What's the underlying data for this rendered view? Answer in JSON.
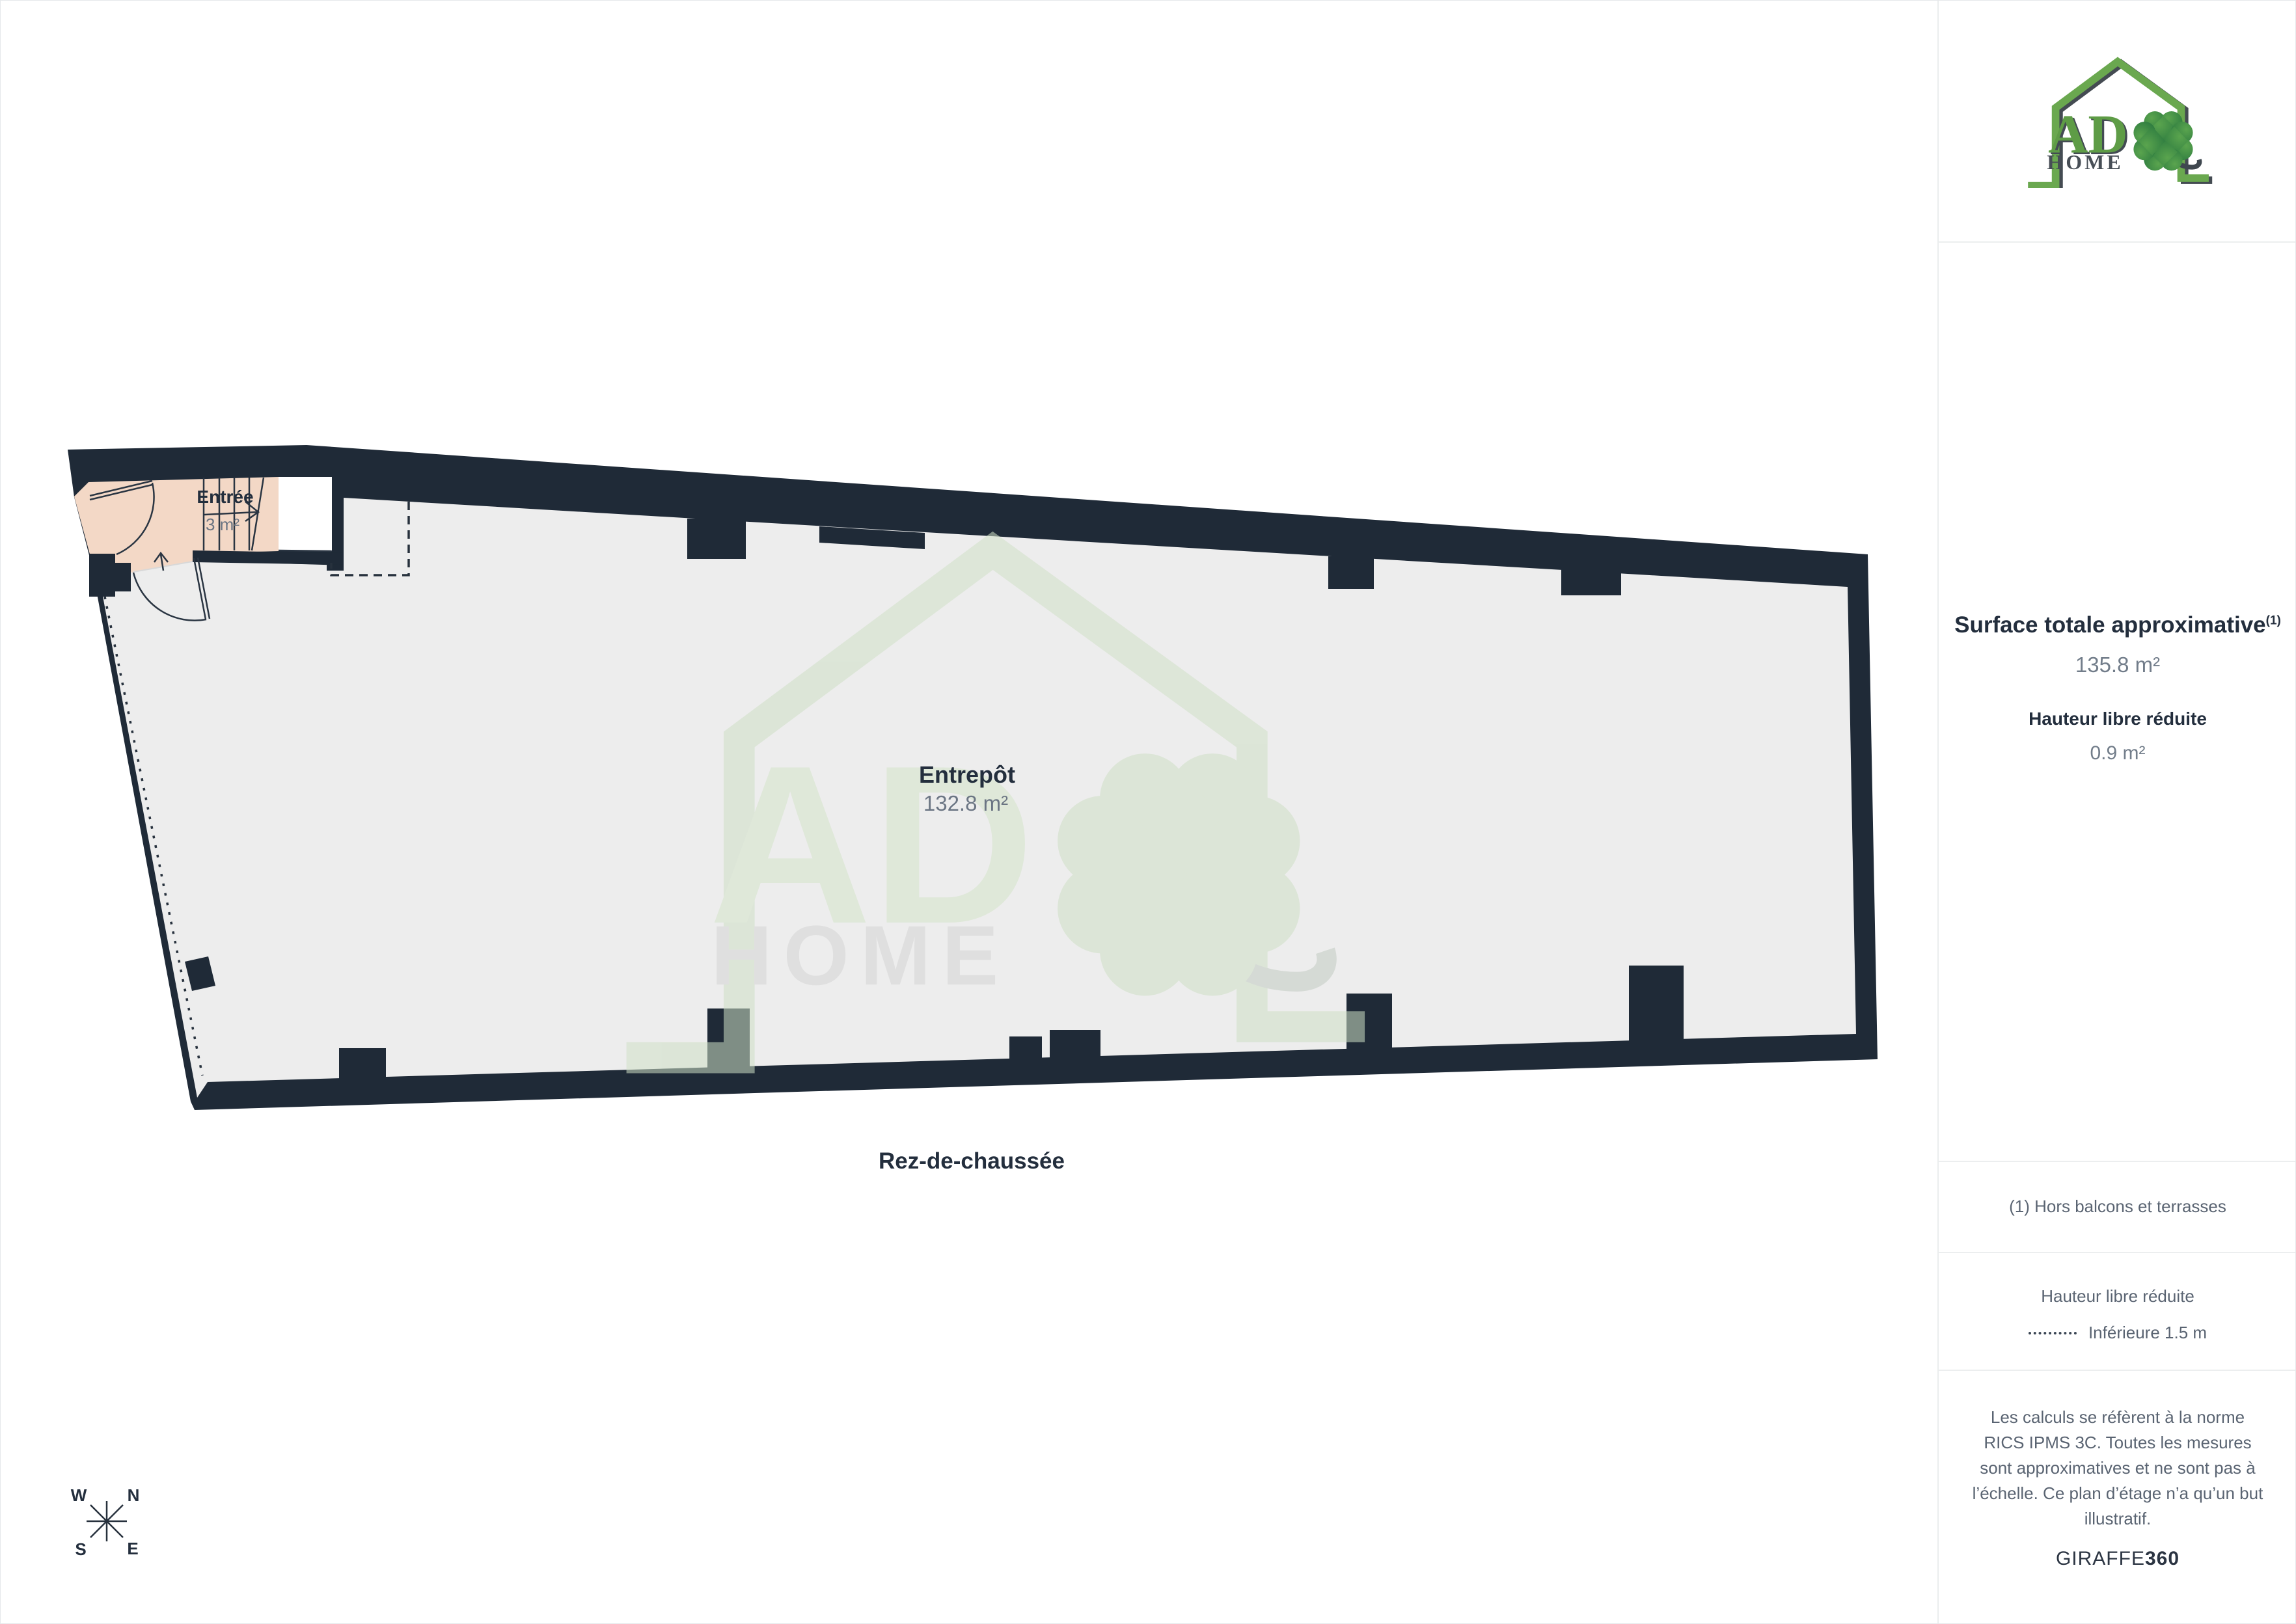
{
  "header_logo": {
    "ad": "AD",
    "home": "HOME"
  },
  "watermark_logo": {
    "ad": "AD",
    "home": "HOME"
  },
  "sidebar": {
    "surface_title": "Surface totale approximative",
    "surface_note_ref": "(1)",
    "surface_value": "135.8 m²",
    "reduced_height_title": "Hauteur libre réduite",
    "reduced_height_value": "0.9 m²",
    "footnote": "(1) Hors balcons et terrasses",
    "legend_title": "Hauteur libre réduite",
    "legend_item": "Inférieure 1.5 m",
    "disclaimer": "Les calculs se réfèrent à la norme RICS IPMS 3C. Toutes les mesures sont approximatives et ne sont pas à l’échelle. Ce plan d’étage n’a qu’un but illustratif.",
    "brand": "GIRAFFE",
    "brand_bold": "360"
  },
  "floorplan": {
    "floor_label": "Rez-de-chaussée",
    "rooms": [
      {
        "name": "Entrée",
        "area": "3 m²"
      },
      {
        "name": "Entrepôt",
        "area": "132.8 m²"
      }
    ],
    "compass": {
      "n": "N",
      "e": "E",
      "s": "S",
      "w": "W"
    },
    "colors": {
      "wall": "#1f2a37",
      "floor": "#ededed",
      "entry_room": "#f3d8c6",
      "accent_green": "#68a24d",
      "text_dark": "#232e3d",
      "text_gray": "#6b7583"
    }
  }
}
